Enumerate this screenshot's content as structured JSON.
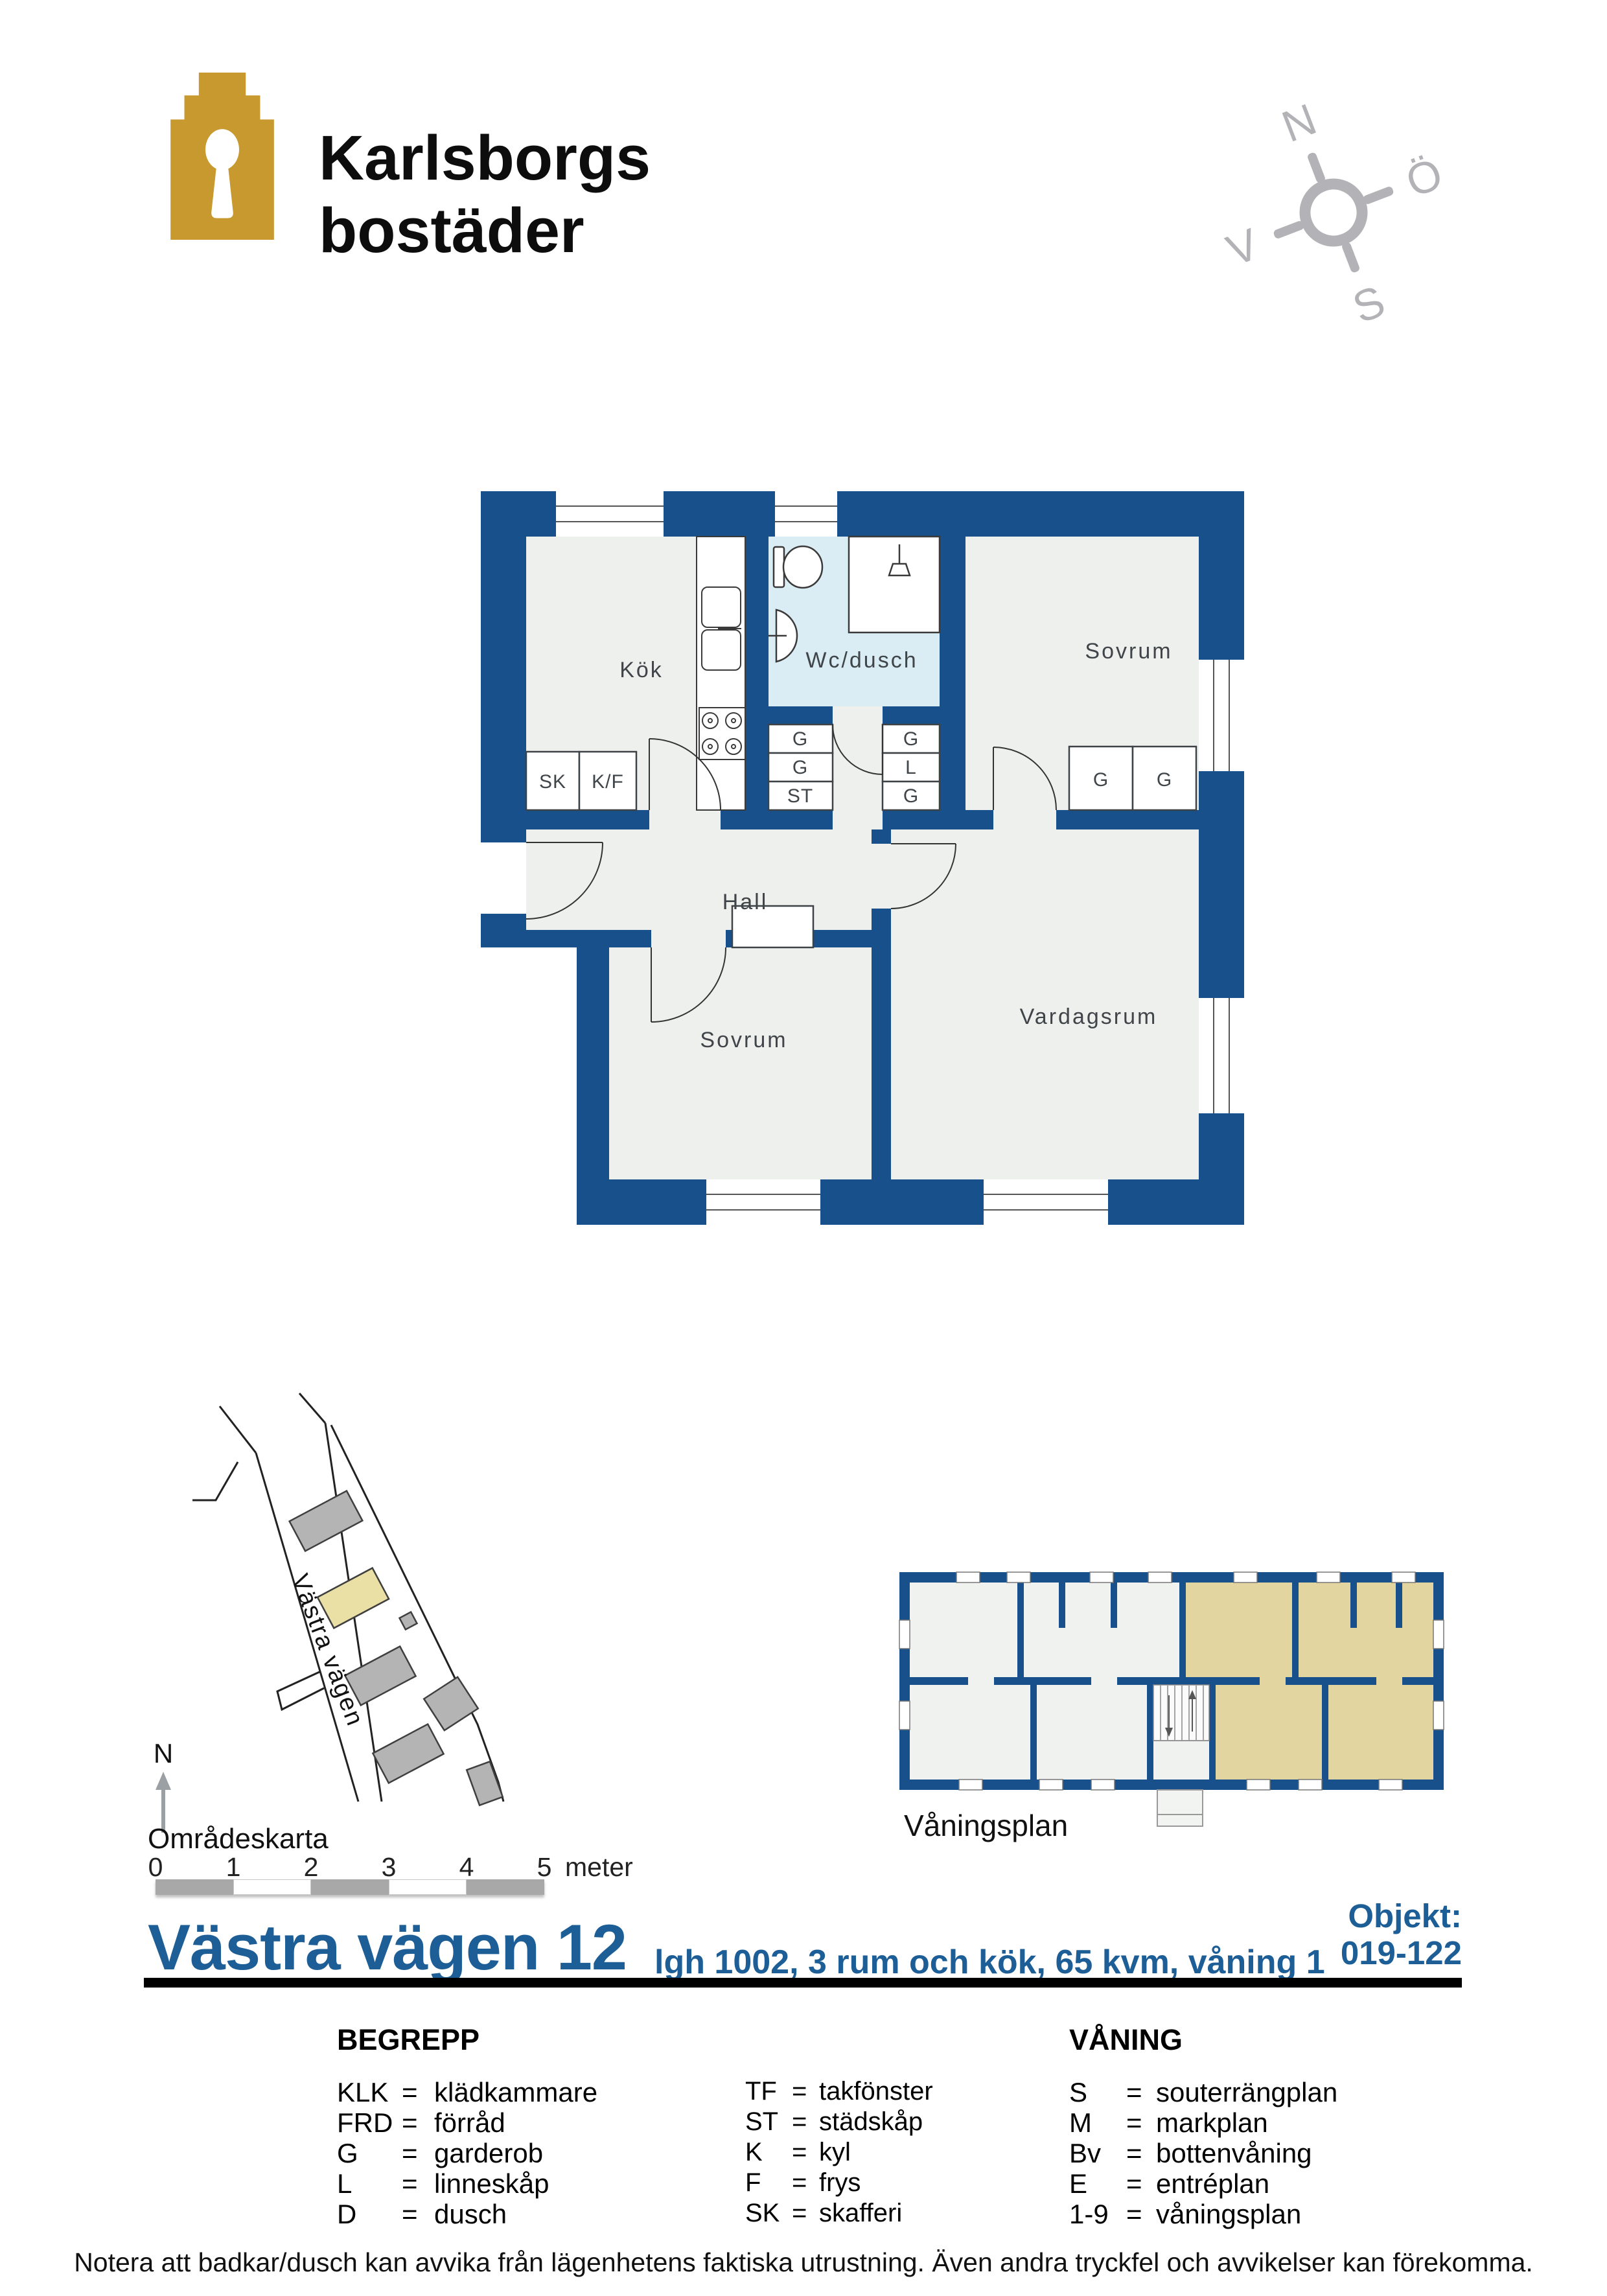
{
  "header": {
    "brand_line1": "Karlsborgs",
    "brand_line2": "bostäder"
  },
  "compass": {
    "north": "N",
    "east": "Ö",
    "south": "S",
    "west": "V"
  },
  "floor_plan": {
    "labels": {
      "kitchen": "Kök",
      "wc": "Wc/dusch",
      "bedroom": "Sovrum",
      "hall": "Hall",
      "living_room": "Vardagsrum",
      "wardrobe": "G",
      "linen": "L",
      "cleaning": "ST",
      "pantry": "SK",
      "fridge_freezer": "K/F"
    }
  },
  "area_map": {
    "street_name": "Västra vägen",
    "north_label": "N",
    "caption": "Områdeskarta"
  },
  "scale_bar": {
    "ticks": [
      "0",
      "1",
      "2",
      "3",
      "4",
      "5"
    ],
    "unit": "meter"
  },
  "overview_plan": {
    "caption": "Våningsplan"
  },
  "title_block": {
    "address": "Västra vägen 12",
    "details": "lgh 1002,  3 rum och kök, 65 kvm, våning 1",
    "object_label": "Objekt:",
    "object_number": "019-122"
  },
  "legend": {
    "eq": "=",
    "begrepp_header": "BEGREPP",
    "vaning_header": "VÅNING",
    "begrepp_col1": [
      {
        "abbr": "KLK",
        "term": "klädkammare"
      },
      {
        "abbr": "FRD",
        "term": "förråd"
      },
      {
        "abbr": "G",
        "term": "garderob"
      },
      {
        "abbr": "L",
        "term": "linneskåp"
      },
      {
        "abbr": "D",
        "term": "dusch"
      }
    ],
    "begrepp_col2": [
      {
        "abbr": "TF",
        "term": "takfönster"
      },
      {
        "abbr": "ST",
        "term": "städskåp"
      },
      {
        "abbr": "K",
        "term": "kyl"
      },
      {
        "abbr": "F",
        "term": "frys"
      },
      {
        "abbr": "SK",
        "term": "skafferi"
      }
    ],
    "vaning": [
      {
        "abbr": "S",
        "term": "souterrängplan"
      },
      {
        "abbr": "M",
        "term": "markplan"
      },
      {
        "abbr": "Bv",
        "term": "bottenvåning"
      },
      {
        "abbr": "E",
        "term": "entréplan"
      },
      {
        "abbr": "1-9",
        "term": "våningsplan"
      }
    ]
  },
  "footer": {
    "note": "Notera att badkar/dusch kan avvika från lägenhetens faktiska utrustning. Även andra tryckfel och avvikelser kan förekomma."
  },
  "colors": {
    "wall_blue": "#17508a",
    "title_blue": "#1d5e96",
    "logo_gold": "#c8992e",
    "room_fill": "#eef0ee",
    "wc_fill": "#daecf4",
    "highlight_tan": "#e3d5a0",
    "map_building_gray": "#b4b4b4",
    "map_building_yellow": "#eadfa4",
    "compass_gray": "#b3b3b7",
    "scalebar_gray": "#a8a8a8"
  }
}
